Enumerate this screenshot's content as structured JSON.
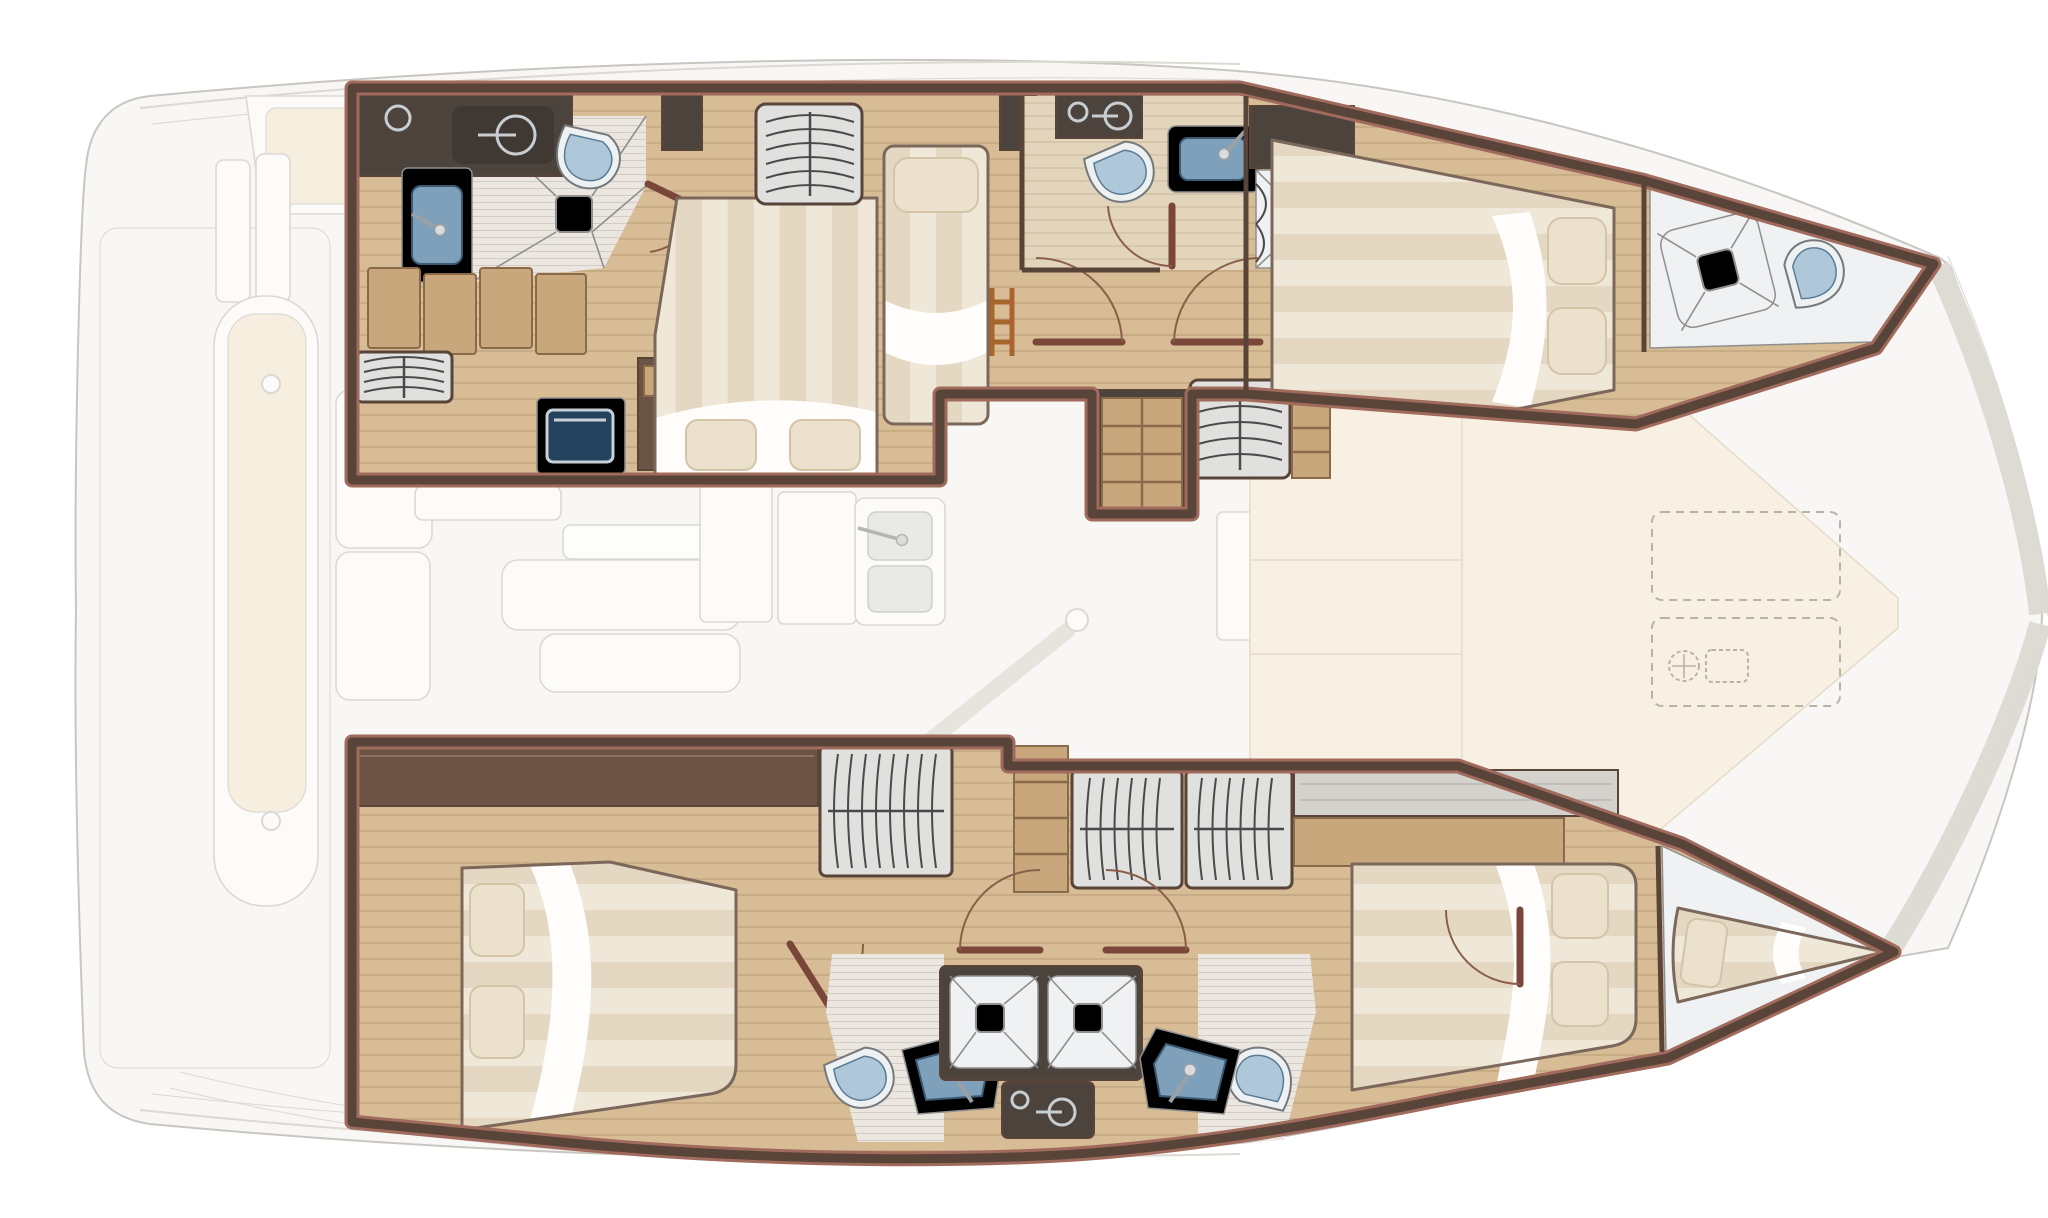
{
  "meta": {
    "title": "Catamaran yacht interior layout — top-view floor plan illustration (no text labels)",
    "view": "top-down",
    "bow_direction": "right",
    "stern_direction": "left"
  },
  "palette": {
    "bg": "#ffffff",
    "hullGhostFill": "#f8f7f5",
    "hullGhostStroke": "#c9c6c1",
    "ghostItemFill": "#fcfbfa",
    "ghostItemStroke": "#dcd9d3",
    "ghostCushion": "#f6efe0",
    "creamPad": "#f8f1e3",
    "creamPadStroke": "#e4dbc8",
    "dashedStroke": "#b9b3a6",
    "bowBand": "#dedbd5",
    "woodFloor": "#d7bc95",
    "woodLight": "#e2d5bc",
    "woodLine": "#7d5e3e",
    "woodMid": "#c9a77c",
    "woodMidEdge": "#8a6a48",
    "woodDark": "#6b5443",
    "charcoal": "#4b433c",
    "wallDark": "#594439",
    "wallEdge": "#a06a5c",
    "tileFloor": "#ebe7e0",
    "marble": "#f0f1f2",
    "marbleStroke": "#8f8f8f",
    "grayStripe": "#e0e0de",
    "grayGrain": "#b9b7b2",
    "arcDark": "#4a4a4a",
    "duvetA": "#efe8d9",
    "duvetB": "#e4d8c3",
    "bedFrame": "#7b685a",
    "pillow": "#ece1cc",
    "pillowStroke": "#d4c5a8",
    "sheetWhite": "#ffffff",
    "toiletBody": "#eef1f2",
    "toiletEdge": "#75797c",
    "toiletLid": "#aec8da",
    "toiletLidEdge": "#5b7c95",
    "sinkBlue": "#7fa0bb",
    "sinkBlueDark": "#3d5a73",
    "faucet": "#9aa1a6",
    "faucetDot": "#d8dcdf",
    "doorLeaf": "#7a463a",
    "doorArc": "#8a5f4a",
    "tvScreen": "#24425d",
    "tvFrame": "#c8d1d8",
    "gridBase": "#f0e4cd",
    "gridLine": "#cbaa80",
    "ladderWood": "#a8662e",
    "counterIcon": "#c8cdd1",
    "softShadow": "#d8d2c9"
  },
  "plan": {
    "upper_hull": [
      {
        "room": "aft-bathroom",
        "features": [
          "vanity-counter-dark",
          "flush-control-icon",
          "washbasin",
          "toilet",
          "shower-floor-with-drain",
          "door"
        ]
      },
      {
        "room": "aft-cabin",
        "features": [
          "drawer-steps",
          "hanging-locker",
          "tv-cabinet",
          "bedside-table",
          "double-island-bed",
          "two-pillows"
        ]
      },
      {
        "room": "middle-cabin",
        "features": [
          "hanging-locker",
          "single-berth",
          "pillow",
          "ladder"
        ]
      },
      {
        "room": "forward-bathroom",
        "features": [
          "flush-control-icon",
          "toilet",
          "washbasin",
          "shower-cubicle",
          "door"
        ]
      },
      {
        "room": "corridor",
        "features": [
          "two-doors",
          "companionway-steps",
          "hanging-locker",
          "shelves"
        ]
      },
      {
        "room": "forward-cabin",
        "features": [
          "double-bed",
          "two-pillows"
        ]
      },
      {
        "room": "forepeak",
        "features": [
          "deck-hatch",
          "toilet"
        ]
      }
    ],
    "lower_hull": [
      {
        "room": "aft-cabin",
        "features": [
          "double-island-bed",
          "two-pillows",
          "door"
        ]
      },
      {
        "room": "corridor",
        "features": [
          "sideboard",
          "hanging-locker-1",
          "shelf-stack",
          "hanging-locker-2",
          "hanging-locker-3",
          "gray-counter",
          "wood-counter"
        ]
      },
      {
        "room": "bathroom-left",
        "features": [
          "toilet",
          "angled-washbasin",
          "shower-tray",
          "door"
        ]
      },
      {
        "room": "bathroom-right",
        "features": [
          "toilet",
          "angled-washbasin",
          "shower-tray",
          "door"
        ]
      },
      {
        "room": "shared-vanity",
        "features": [
          "dark-counter",
          "flush-control-icon"
        ]
      },
      {
        "room": "forward-cabin",
        "features": [
          "double-bed",
          "two-pillows",
          "door"
        ]
      },
      {
        "room": "forepeak",
        "features": [
          "v-berth",
          "pillow"
        ]
      }
    ],
    "main_deck_ghosted": {
      "aft_deck": [
        "helm-bench",
        "davit-posts",
        "dinghy-with-cushion",
        "two-cleats",
        "bench-seats",
        "swim-platform-lines"
      ],
      "salon": [
        "side-table",
        "dining-table",
        "l-sofa",
        "cabinet-panels",
        "double-sink-with-faucet",
        "table-knob"
      ],
      "galley_forward": [
        "cabinet-row",
        "stove-two-burners",
        "grid-mat",
        "counter-panels"
      ],
      "foredeck": [
        "cream-sunpad",
        "seam-lines",
        "two-dashed-lockers",
        "windlass-icon"
      ]
    }
  }
}
